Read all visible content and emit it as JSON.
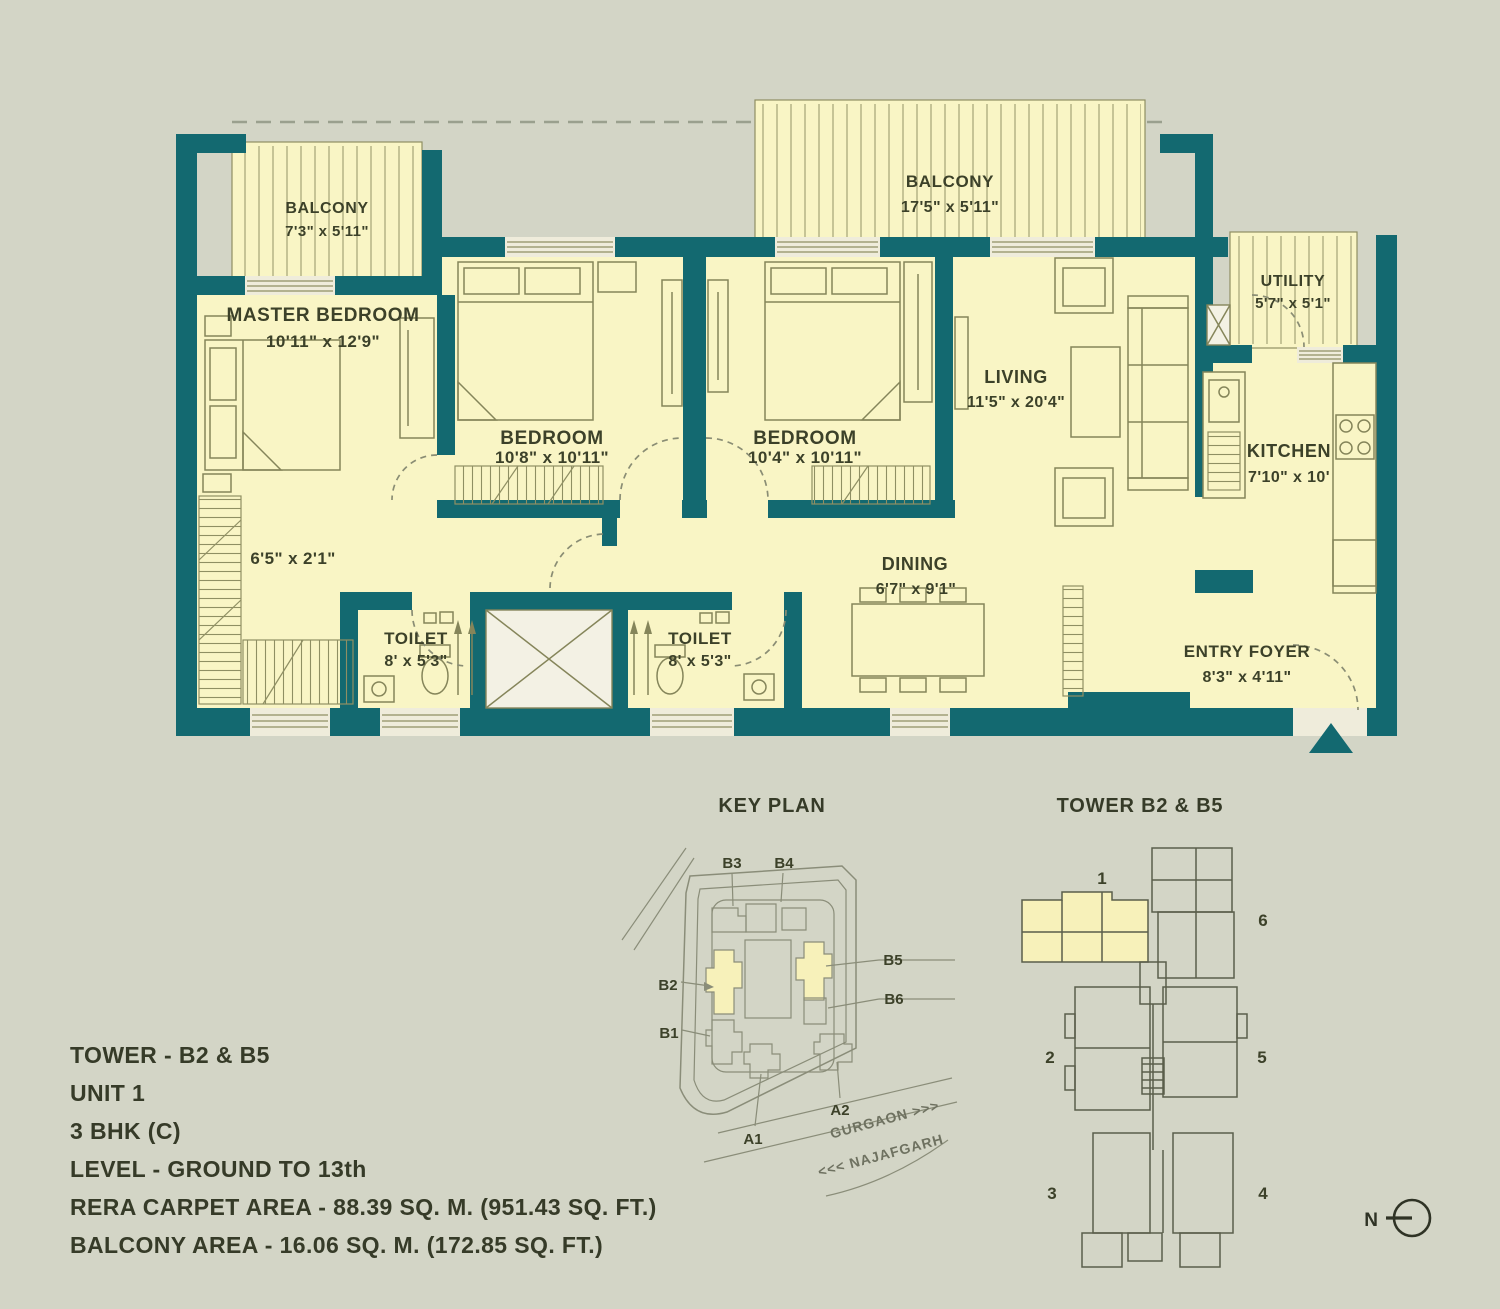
{
  "colors": {
    "background": "#d3d5c6",
    "wall": "#136970",
    "floor": "#f9f5c5",
    "hatch_line": "#a9a97c",
    "furniture_line": "#85855a",
    "label_text": "#3c4129",
    "info_text": "#363b28",
    "tower_highlight": "#f7f1ba"
  },
  "floor_plan": {
    "rooms": [
      {
        "id": "balcony-small",
        "name": "BALCONY",
        "dims": "7'3\" x 5'11\""
      },
      {
        "id": "balcony-large",
        "name": "BALCONY",
        "dims": "17'5\" x 5'11\""
      },
      {
        "id": "master-bedroom",
        "name": "MASTER BEDROOM",
        "dims": "10'11\" x 12'9\""
      },
      {
        "id": "bedroom-2",
        "name": "BEDROOM",
        "dims": "10'8\" x 10'11\""
      },
      {
        "id": "bedroom-3",
        "name": "BEDROOM",
        "dims": "10'4\" x 10'11\""
      },
      {
        "id": "living",
        "name": "LIVING",
        "dims": "11'5\" x 20'4\""
      },
      {
        "id": "utility",
        "name": "UTILITY",
        "dims": "5'7\" x 5'1\""
      },
      {
        "id": "kitchen",
        "name": "KITCHEN",
        "dims": "7'10\" x 10'"
      },
      {
        "id": "dining",
        "name": "DINING",
        "dims": "6'7\" x 9'1\""
      },
      {
        "id": "toilet-1",
        "name": "TOILET",
        "dims": "8' x 5'3\""
      },
      {
        "id": "toilet-2",
        "name": "TOILET",
        "dims": "8' x 5'3\""
      },
      {
        "id": "entry-foyer",
        "name": "ENTRY FOYER",
        "dims": "8'3\" x 4'11\""
      },
      {
        "id": "dress-passage",
        "name": "",
        "dims": "6'5\" x 2'1\""
      }
    ]
  },
  "info": {
    "lines": [
      "TOWER - B2 & B5",
      "UNIT 1",
      "3 BHK (C)",
      "LEVEL - GROUND TO 13th",
      "RERA CARPET AREA - 88.39 SQ. M. (951.43 SQ. FT.)",
      "BALCONY AREA - 16.06 SQ. M. (172.85 SQ. FT.)"
    ]
  },
  "key_plan": {
    "title": "KEY PLAN",
    "labels": [
      "B3",
      "B4",
      "B2",
      "B1",
      "B5",
      "B6",
      "A1",
      "A2"
    ],
    "roads": [
      "GURGAON >>>",
      "<<< NAJAFGARH"
    ]
  },
  "tower_plan": {
    "title": "TOWER B2 & B5",
    "units": [
      "1",
      "2",
      "3",
      "4",
      "5",
      "6"
    ],
    "compass": "N"
  }
}
